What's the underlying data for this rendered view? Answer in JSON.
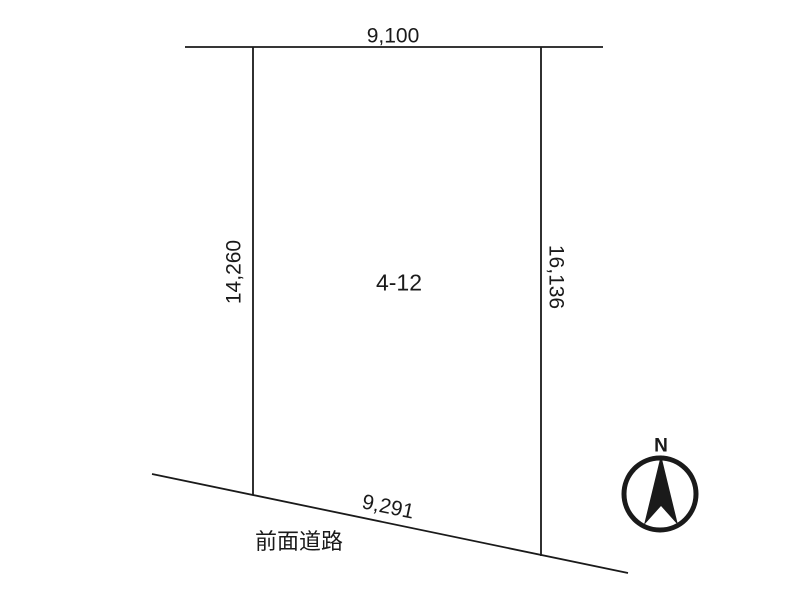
{
  "diagram": {
    "lot": {
      "label": "4-12"
    },
    "dimensions": {
      "top": "9,100",
      "left": "14,260",
      "right": "16,136",
      "bottom": "9,291"
    },
    "road": {
      "label": "前面道路"
    },
    "compass": {
      "north_label": "N"
    },
    "colors": {
      "background": "#ffffff",
      "line": "#1a1a1a",
      "text": "#1a1a1a"
    }
  }
}
